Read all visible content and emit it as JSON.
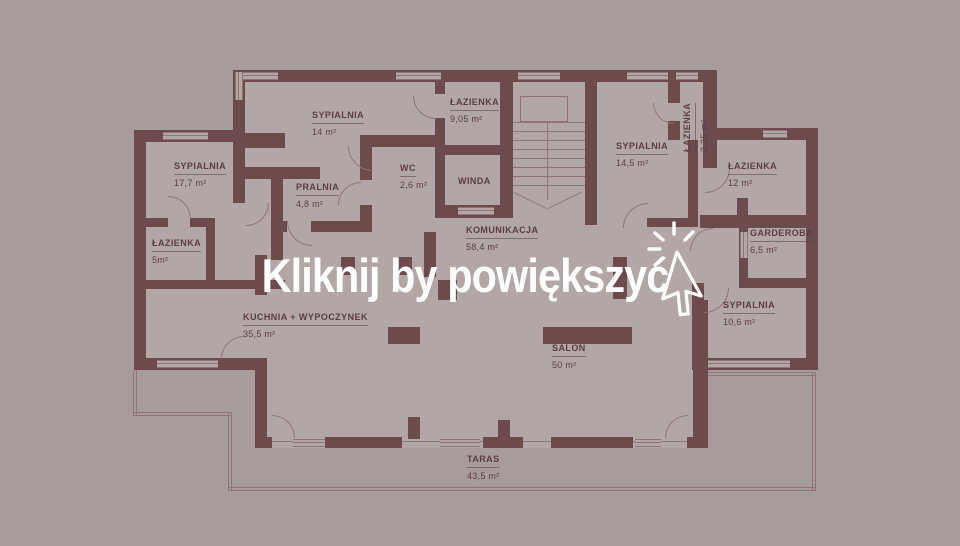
{
  "overlay": {
    "cta": "Kliknij by powiększyć",
    "cursor_icon": "cursor-arrow-click-icon"
  },
  "colors": {
    "background": "#a89b9c",
    "floor": "#b3a6a7",
    "wall": "#6d4a4b",
    "thin_line": "#8f7576",
    "label_text": "#5a3e40",
    "overlay_text": "#ffffff"
  },
  "rooms": [
    {
      "name": "SYPIALNIA",
      "area": "17,7 m²"
    },
    {
      "name": "ŁAZIENKA",
      "area": "5m²"
    },
    {
      "name": "SYPIALNIA",
      "area": "14 m²"
    },
    {
      "name": "PRALNIA",
      "area": "4,8 m²"
    },
    {
      "name": "WC",
      "area": "2,6 m²"
    },
    {
      "name": "ŁAZIENKA",
      "area": "9,05 m²"
    },
    {
      "name": "WINDA",
      "area": ""
    },
    {
      "name": "SYPIALNIA",
      "area": "14,5 m²"
    },
    {
      "name": "ŁAZIENKA",
      "area": "2,35 m²"
    },
    {
      "name": "ŁAZIENKA",
      "area": "12 m²"
    },
    {
      "name": "GARDEROBA",
      "area": "6,5 m²"
    },
    {
      "name": "SYPIALNIA",
      "area": "10,6 m²"
    },
    {
      "name": "KOMUNIKACJA",
      "area": "58,4 m²"
    },
    {
      "name": "KUCHNIA + WYPOCZYNEK",
      "area": "35,5 m²"
    },
    {
      "name": "SALON",
      "area": "50 m²"
    },
    {
      "name": "TARAS",
      "area": "43,5 m²"
    }
  ]
}
